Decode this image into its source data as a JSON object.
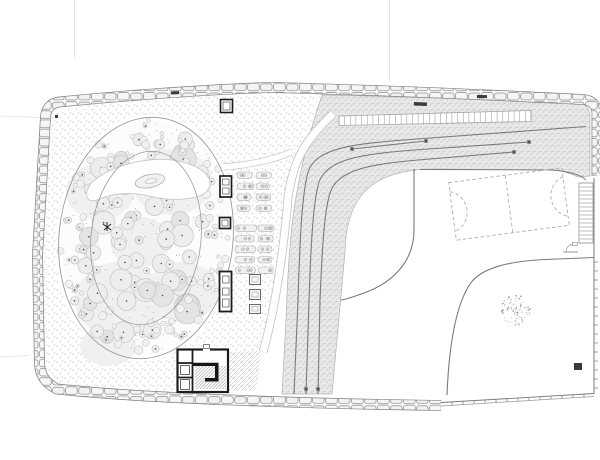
{
  "canvas": {
    "width": 600,
    "height": 460,
    "background": "#ffffff"
  },
  "palette": {
    "paper": "#ffffff",
    "ink": "#1c1c1c",
    "wall_black": "#161616",
    "line": "#7a7a7a",
    "mid": "#9a9a9a",
    "light": "#c0c0c0",
    "faint": "#dedede",
    "road_band_fill": "#e8e8e8",
    "stipple_dot": "#8f8f8f",
    "tree_fill": "#ededed",
    "tree_edge": "#bfbfbf",
    "canopy_blob": "#f0f0f0",
    "stone_fill": "#f4f4f4"
  },
  "drawing": {
    "seed": 123456,
    "garden_grove": {
      "tree_count": 118,
      "shrub_count": 72,
      "inner_dot_count": 170,
      "ellipse": {
        "cx": 146,
        "cy": 238,
        "rx": 87,
        "ry": 121,
        "rotation_deg": 6
      },
      "inner_ellipse": {
        "rx": 55,
        "ry": 87
      },
      "canopy_blobs": [
        [
          120,
          300,
          45,
          38
        ],
        [
          172,
          182,
          40,
          33
        ],
        [
          100,
          192,
          34,
          28
        ],
        [
          182,
          292,
          36,
          30
        ],
        [
          140,
          242,
          30,
          25
        ],
        [
          108,
          346,
          28,
          20
        ]
      ]
    },
    "planter_groups": [
      {
        "x": 237,
        "y": 172,
        "rows": 4,
        "row_gap": 11,
        "pills": [
          [
            0,
            15
          ],
          [
            19,
            15
          ]
        ]
      },
      {
        "x": 235,
        "y": 225,
        "rows": 5,
        "row_gap": 10.5,
        "pills": [
          [
            0,
            20
          ],
          [
            23,
            15
          ]
        ]
      }
    ],
    "court": {
      "cx": 509,
      "cy": 204,
      "width": 114,
      "height": 58,
      "rotation_deg": -7.5,
      "arc_radius": 21
    },
    "lone_tree": {
      "cx": 516,
      "cy": 310,
      "radius": 15,
      "dot_count": 85
    },
    "road_end_dots": [
      [
        529,
        142
      ],
      [
        514,
        152
      ],
      [
        426,
        141
      ],
      [
        352,
        149
      ],
      [
        306,
        389
      ],
      [
        318,
        389
      ]
    ],
    "gate_dashes": [
      [
        414,
        102,
        13,
        3.5,
        2
      ],
      [
        171,
        91.5,
        8,
        3,
        -3
      ],
      [
        477,
        95,
        10,
        3,
        1
      ],
      [
        55,
        115,
        3,
        3,
        0
      ],
      [
        574,
        363,
        8,
        7,
        0
      ]
    ],
    "tick_marks": {
      "right_edge": {
        "x": 594,
        "y_start": 262,
        "y_end": 388,
        "step": 9,
        "len": 4
      },
      "bottom_edge": {
        "x_start": 452,
        "x_end": 590,
        "step": 11,
        "y_at_start": 402.5,
        "y_at_end": 394.5,
        "len": 3.5
      }
    },
    "ladders": {
      "top": {
        "x1": 339,
        "x2": 531,
        "y_top1": 116,
        "y_top2": 110.5,
        "y_bot1": 125.5,
        "y_bot2": 121.5,
        "rungs": 34
      },
      "right": {
        "x": 579,
        "y": 183,
        "w": 14,
        "h": 60,
        "rungs": 15
      }
    }
  }
}
